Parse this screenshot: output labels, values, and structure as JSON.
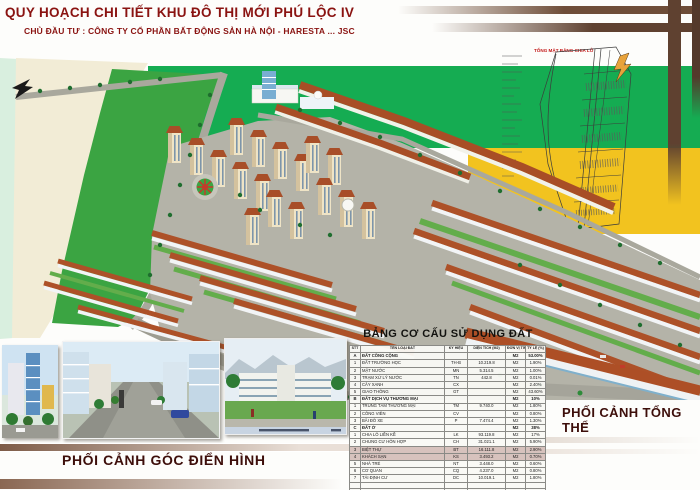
{
  "header": {
    "title": "QUY HOẠCH CHI TIẾT KHU ĐÔ THỊ MỚI PHÚ LỘC IV",
    "subtitle": "CHỦ ĐẦU TƯ : CÔNG TY CỔ PHẦN BẤT ĐỘNG SẢN HÀ NỘI - HARESTA ... JSC"
  },
  "site_plan": {
    "label": "TỔNG MẶT BẰNG CHIA LÔ"
  },
  "captions": {
    "bottom_left": "PHỐI CẢNH GÓC ĐIỂN HÌNH",
    "bottom_right": "PHỐI CẢNH TỔNG THỂ"
  },
  "table": {
    "title": "BẢNG CƠ CẤU SỬ DỤNG ĐẤT",
    "headers": [
      "STT",
      "TÊN LOẠI ĐẤT",
      "KÝ HIỆU",
      "DIỆN TÍCH (M2)",
      "ĐƠN VỊ TÍNH",
      "TỶ LỆ (%)"
    ],
    "rows": [
      {
        "stt": "A",
        "name": "ĐẤT CÔNG CỘNG",
        "code": "",
        "area": "",
        "unit": "M2",
        "pct": "53.00%",
        "section": true
      },
      {
        "stt": "1",
        "name": "ĐẤT TRƯỜNG HỌC",
        "code": "TH-B",
        "area": "10.219.8",
        "unit": "M2",
        "pct": "1.90%"
      },
      {
        "stt": "2",
        "name": "MẶT NƯỚC",
        "code": "MN",
        "area": "5.314.5",
        "unit": "M2",
        "pct": "1.00%"
      },
      {
        "stt": "3",
        "name": "TRẠM XỬ LÝ NƯỚC",
        "code": "TN",
        "area": "442.8",
        "unit": "M2",
        "pct": "0.01%"
      },
      {
        "stt": "4",
        "name": "CÂY XANH",
        "code": "CX",
        "area": "",
        "unit": "M2",
        "pct": "2.40%"
      },
      {
        "stt": "5",
        "name": "GIAO THÔNG",
        "code": "GT",
        "area": "",
        "unit": "M2",
        "pct": "43.60%"
      },
      {
        "stt": "B",
        "name": "ĐẤT DỊCH VỤ THƯƠNG MẠI",
        "code": "",
        "area": "",
        "unit": "M2",
        "pct": "10%",
        "section": true
      },
      {
        "stt": "1",
        "name": "TRUNG TÂM THƯƠNG MẠI",
        "code": "TM",
        "area": "9.740.0",
        "unit": "M2",
        "pct": "1.80%"
      },
      {
        "stt": "2",
        "name": "CÔNG VIÊN",
        "code": "CV",
        "area": "",
        "unit": "M2",
        "pct": "0.80%"
      },
      {
        "stt": "3",
        "name": "BÃI ĐỖ XE",
        "code": "P",
        "area": "7.474.4",
        "unit": "M2",
        "pct": "1.30%"
      },
      {
        "stt": "C",
        "name": "ĐẤT Ở",
        "code": "",
        "area": "",
        "unit": "M2",
        "pct": "38%",
        "section": true
      },
      {
        "stt": "1",
        "name": "CHIA LÔ LIỀN KỀ",
        "code": "LK",
        "area": "93.119.8",
        "unit": "M2",
        "pct": "17%"
      },
      {
        "stt": "2",
        "name": "CHUNG CƯ HỖN HỢP",
        "code": "CH",
        "area": "31.021.1",
        "unit": "M2",
        "pct": "5.90%"
      },
      {
        "stt": "3",
        "name": "BIỆT THỰ",
        "code": "BT",
        "area": "16.111.8",
        "unit": "M2",
        "pct": "2.90%",
        "highlight": true
      },
      {
        "stt": "4",
        "name": "KHÁCH SẠN",
        "code": "KS",
        "area": "3.493.2",
        "unit": "M2",
        "pct": "0.70%",
        "highlight": true
      },
      {
        "stt": "5",
        "name": "NHÀ TRẺ",
        "code": "NT",
        "area": "3.448.0",
        "unit": "M2",
        "pct": "0.60%"
      },
      {
        "stt": "6",
        "name": "CƠ QUAN",
        "code": "CQ",
        "area": "4.237.0",
        "unit": "M2",
        "pct": "0.80%"
      },
      {
        "stt": "7",
        "name": "TÁI ĐỊNH CƯ",
        "code": "DC",
        "area": "10.019.1",
        "unit": "M2",
        "pct": "1.80%"
      },
      {
        "stt": "",
        "name": "",
        "code": "",
        "area": "",
        "unit": "",
        "pct": "",
        "spacer": true
      },
      {
        "stt": "D",
        "name": "TỔNG CỘNG",
        "code": "",
        "area": "553.548.8",
        "unit": "M2",
        "pct": "100.00%",
        "section": true,
        "total": true
      }
    ]
  },
  "colors": {
    "accent_maroon": "#8a1311",
    "band_green": "#15ac52",
    "band_yellow": "#f2c31f",
    "bar_brown": "#6e4d38",
    "highlight_row": "#d7c2bd"
  }
}
